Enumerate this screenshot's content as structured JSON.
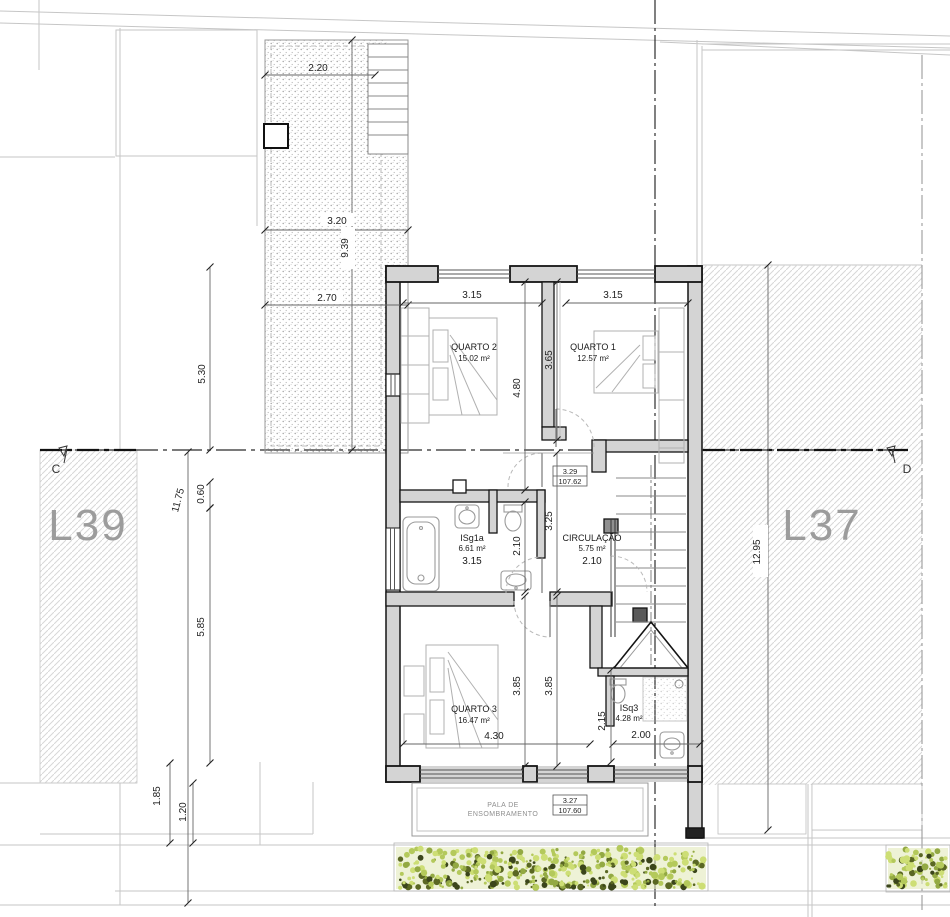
{
  "lots": {
    "left": "L39",
    "right": "L37"
  },
  "section_markers": {
    "left": "C",
    "right": "D"
  },
  "rooms": {
    "quarto2": {
      "name": "QUARTO 2",
      "area": "15.02 m²"
    },
    "quarto1": {
      "name": "QUARTO 1",
      "area": "12.57 m²"
    },
    "isg1a": {
      "name": "ISg1a",
      "area": "6.61 m²",
      "width": "3.15"
    },
    "circulacao": {
      "name": "CIRCULAÇÃO",
      "area": "5.75 m²",
      "width": "2.10"
    },
    "quarto3": {
      "name": "QUARTO 3",
      "area": "16.47 m²"
    },
    "isq3": {
      "name": "ISq3",
      "area": "4.28 m²"
    }
  },
  "levels": {
    "upper": {
      "value": "3.29",
      "datum": "107.62"
    },
    "canopy": {
      "value": "3.27",
      "datum": "107.60"
    }
  },
  "canopy_label": {
    "line1": "PALA DE",
    "line2": "ENSOMBRAMENTO"
  },
  "dims": {
    "terrace_w1": "2.20",
    "terrace_w2": "3.20",
    "terrace_depth": "9.39",
    "terrace_w3": "2.70",
    "left_upper": "5.30",
    "left_total": "11.75",
    "left_small": "0.60",
    "left_lower": "5.85",
    "left_b1": "1.85",
    "left_b2": "1.20",
    "q2_width": "3.15",
    "q1_width": "3.15",
    "q2_depth": "4.80",
    "q1_depth": "3.65",
    "corridor_depth": "3.25",
    "bath_depth": "2.10",
    "q3_depth_a": "3.85",
    "q3_depth_b": "3.85",
    "q3_width": "4.30",
    "isq3_depth": "2.15",
    "isq3_width": "2.00",
    "right_depth": "12.95"
  },
  "colors": {
    "wall_fill": "#d4d4d4",
    "hedge": [
      "#cdde75",
      "#b4c95b",
      "#93a943",
      "#5a6723",
      "#3b451b"
    ]
  }
}
